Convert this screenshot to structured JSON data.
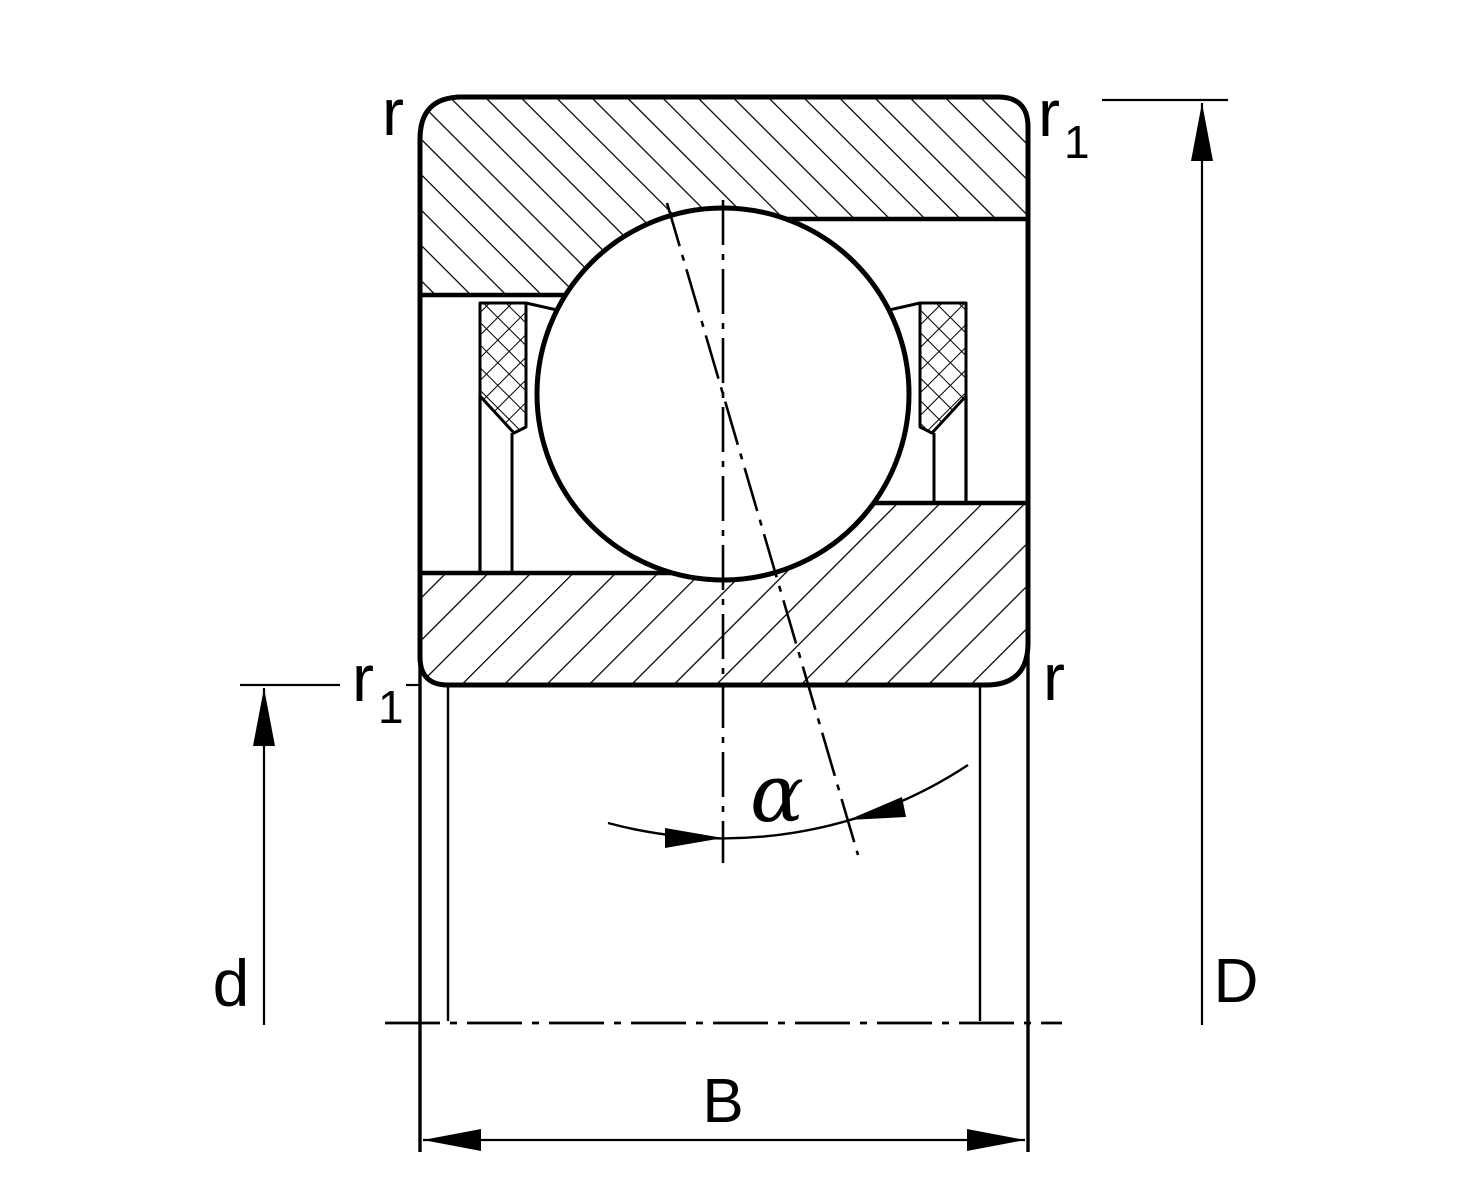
{
  "colors": {
    "line": "#000000",
    "background": "#ffffff"
  },
  "diagram": {
    "type": "bearing-cross-section",
    "labels": {
      "corner_radius_top_left": "r",
      "corner_radius_top_right_base": "r",
      "corner_radius_top_right_sub": "1",
      "corner_radius_bottom_left_base": "r",
      "corner_radius_bottom_left_sub": "1",
      "corner_radius_bottom_right": "r",
      "contact_angle": "α",
      "bore_diameter": "d",
      "outer_diameter": "D",
      "width": "B"
    }
  }
}
